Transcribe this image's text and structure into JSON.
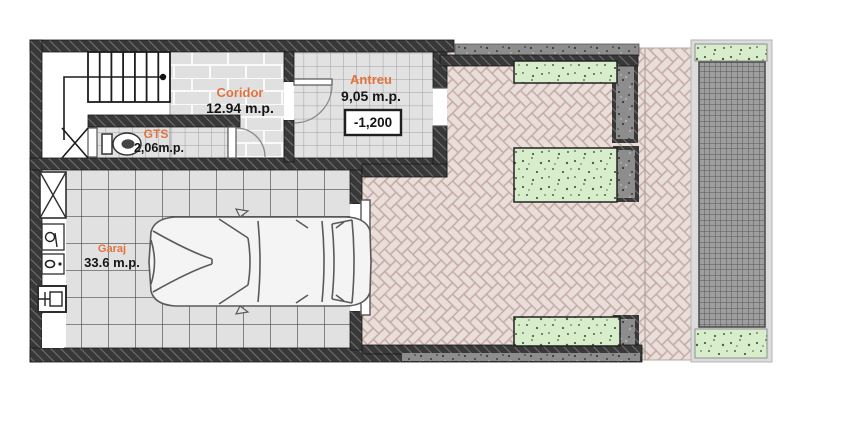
{
  "plan": {
    "rooms": [
      {
        "name": "Coridor",
        "area": "12.94 m.p."
      },
      {
        "name": "Antreu",
        "area": "9,05 m.p."
      },
      {
        "name": "GTS",
        "area": "2,06m.p."
      },
      {
        "name": "Garaj",
        "area": "33.6 m.p."
      }
    ],
    "annotations": {
      "antreu_level": "-1,200"
    },
    "colors": {
      "wall": "#383838",
      "label_accent": "#e0733d",
      "label_value": "#141414",
      "paving": "#eadeda",
      "paving_joint": "#c3aba3",
      "planter_green": "#d8edcc",
      "floor_tile": "#e2e2e2",
      "concrete": "#8d8d8d",
      "grating": "#9e9e9e"
    },
    "icons": [
      "staircase",
      "toilet-icon",
      "car-top-view-icon",
      "shaft-x-icon",
      "drain-icon",
      "outlet-icon",
      "electrical-panel-icon"
    ]
  }
}
